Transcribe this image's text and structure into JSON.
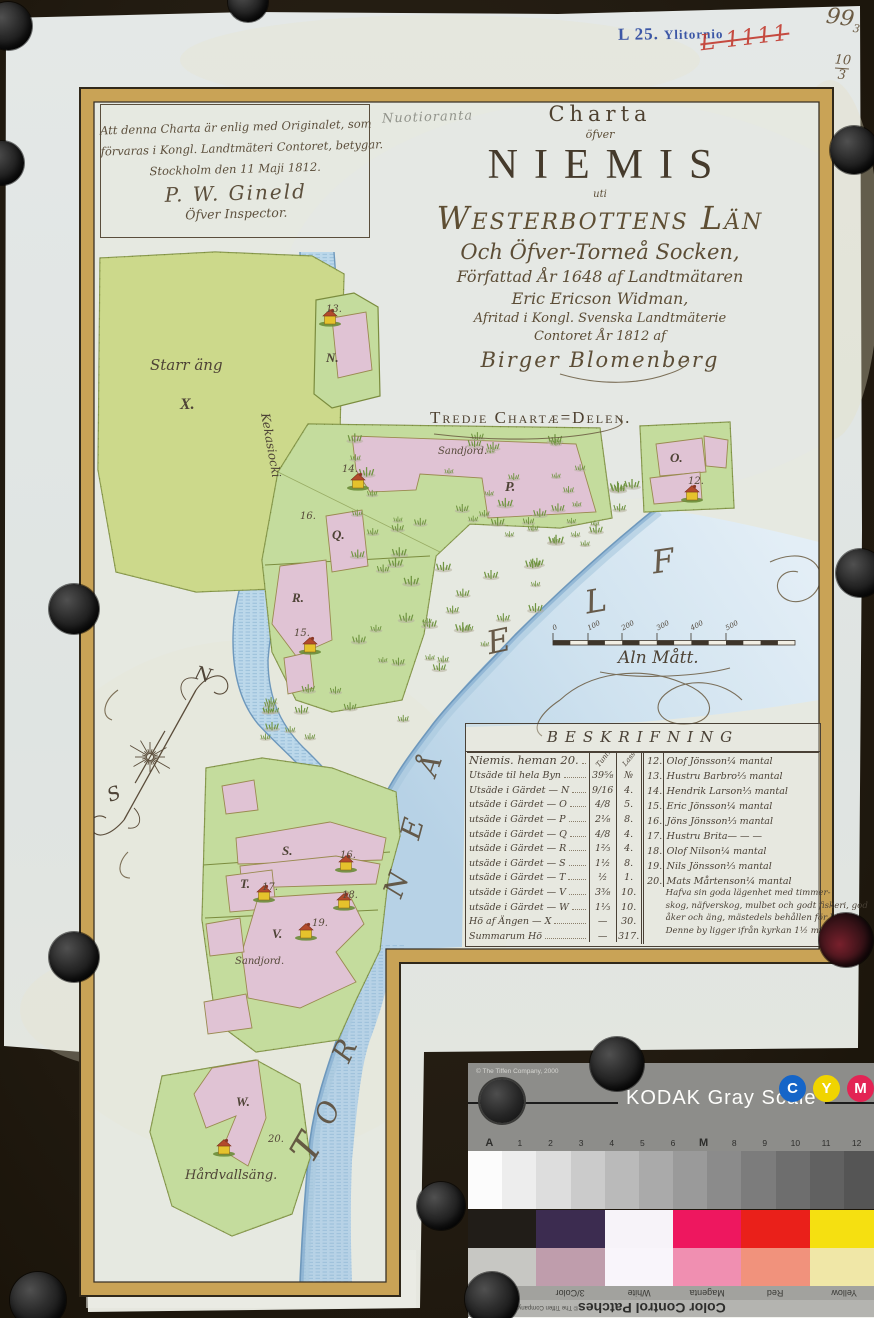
{
  "archive": {
    "stamp_l": "L 25.",
    "stamp_place": "Ylitornio",
    "red_mark": "L 1111",
    "corner_no": "99",
    "corner_no_sub": "3",
    "fraction_top": "10",
    "fraction_bottom": "3",
    "pencil_note": "Nuotioranta"
  },
  "certification": {
    "lines": [
      "Att denna Charta är enlig med Originalet, som",
      "förvaras i Kongl. Landtmäteri Contoret, betygar.",
      "Stockholm den 11 Maji 1812.",
      "P. W. Gineld",
      "Öfver Inspector."
    ]
  },
  "title": {
    "lines": [
      "Charta",
      "öfver",
      "NIEMIS",
      "uti",
      "Westerbottens Län",
      "Och Öfver-Torneå Socken,",
      "Författad År 1648 af Landtmätaren",
      "Eric Ericson Widman,",
      "Afritad i Kongl. Svenska Landtmäterie",
      "Contoret År 1812 af",
      "Birger Blomenberg"
    ],
    "section": "Tredje Chartæ=Delen."
  },
  "map": {
    "labels": [
      {
        "t": "Starr äng",
        "x": 150,
        "y": 356,
        "c": "cursive",
        "s": 15
      },
      {
        "t": "X.",
        "x": 180,
        "y": 396,
        "c": "serif",
        "s": 16
      },
      {
        "t": "Kekasiocki",
        "x": 272,
        "y": 412,
        "c": "cursive",
        "s": 12,
        "r": 80
      },
      {
        "t": "13.",
        "x": 326,
        "y": 304,
        "c": "small"
      },
      {
        "t": "N.",
        "x": 326,
        "y": 350,
        "c": "serif",
        "s": 13
      },
      {
        "t": "Sandjord.",
        "x": 438,
        "y": 446,
        "c": "small"
      },
      {
        "t": "14.",
        "x": 342,
        "y": 464,
        "c": "small"
      },
      {
        "t": "P.",
        "x": 505,
        "y": 480,
        "c": "serif",
        "s": 14
      },
      {
        "t": "16.",
        "x": 300,
        "y": 511,
        "c": "small"
      },
      {
        "t": "Q.",
        "x": 332,
        "y": 527,
        "c": "serif",
        "s": 13
      },
      {
        "t": "R.",
        "x": 292,
        "y": 590,
        "c": "serif",
        "s": 13
      },
      {
        "t": "15.",
        "x": 294,
        "y": 628,
        "c": "small"
      },
      {
        "t": "O.",
        "x": 670,
        "y": 450,
        "c": "serif",
        "s": 13
      },
      {
        "t": "12.",
        "x": 688,
        "y": 476,
        "c": "small"
      },
      {
        "t": "S.",
        "x": 282,
        "y": 843,
        "c": "serif",
        "s": 13
      },
      {
        "t": "16.",
        "x": 340,
        "y": 850,
        "c": "small"
      },
      {
        "t": "T.",
        "x": 240,
        "y": 876,
        "c": "serif",
        "s": 13
      },
      {
        "t": "17.",
        "x": 262,
        "y": 882,
        "c": "small"
      },
      {
        "t": "18.",
        "x": 342,
        "y": 890,
        "c": "small"
      },
      {
        "t": "V.",
        "x": 272,
        "y": 926,
        "c": "serif",
        "s": 13
      },
      {
        "t": "19.",
        "x": 312,
        "y": 918,
        "c": "small"
      },
      {
        "t": "Sandjord.",
        "x": 235,
        "y": 956,
        "c": "small"
      },
      {
        "t": "W.",
        "x": 236,
        "y": 1094,
        "c": "serif",
        "s": 13
      },
      {
        "t": "20.",
        "x": 268,
        "y": 1134,
        "c": "small"
      },
      {
        "t": "Hårdvallsäng.",
        "x": 185,
        "y": 1168,
        "c": "cursive",
        "s": 13
      },
      {
        "t": "N",
        "x": 198,
        "y": 662,
        "c": "cursive",
        "s": 19,
        "r": 15
      },
      {
        "t": "S",
        "x": 104,
        "y": 786,
        "c": "cursive",
        "s": 19,
        "r": -20
      }
    ],
    "river_letters": [
      {
        "ch": "E",
        "x": 487,
        "y": 622,
        "r": -12,
        "s": 32
      },
      {
        "ch": "L",
        "x": 585,
        "y": 582,
        "r": -10,
        "s": 32
      },
      {
        "ch": "F",
        "x": 652,
        "y": 542,
        "r": -8,
        "s": 32
      },
      {
        "ch": "Å",
        "x": 420,
        "y": 748,
        "r": -70,
        "s": 28
      },
      {
        "ch": "E",
        "x": 402,
        "y": 812,
        "r": -75,
        "s": 28
      },
      {
        "ch": "N",
        "x": 384,
        "y": 868,
        "r": -70,
        "s": 28
      },
      {
        "ch": "R",
        "x": 334,
        "y": 1034,
        "r": -65,
        "s": 28
      },
      {
        "ch": "O",
        "x": 316,
        "y": 1096,
        "r": -70,
        "s": 28
      },
      {
        "ch": "T",
        "x": 294,
        "y": 1126,
        "r": -60,
        "s": 38
      }
    ],
    "scale": {
      "ticks": [
        "0",
        "100",
        "200",
        "300",
        "400",
        "500"
      ],
      "caption": "Aln Mått."
    }
  },
  "table": {
    "header": "BESKRIFNING",
    "col_heads": [
      "Tunl.",
      "Lass"
    ],
    "no_head": "№",
    "left_rows": [
      {
        "n": "Niemis. heman 20.",
        "v1": "",
        "v2": ""
      },
      {
        "n": "Utsäde til hela Byn",
        "v1": "39⅝",
        "v2": "№"
      },
      {
        "n": "Utsäde i Gärdet — N",
        "v1": "9/16",
        "v2": "4."
      },
      {
        "n": "utsäde i Gärdet — O",
        "v1": "4/8",
        "v2": "5."
      },
      {
        "n": "utsäde i Gärdet — P",
        "v1": "2⅛",
        "v2": "8."
      },
      {
        "n": "utsäde i Gärdet — Q",
        "v1": "4/8",
        "v2": "4."
      },
      {
        "n": "utsäde i Gärdet — R",
        "v1": "1⅔",
        "v2": "4."
      },
      {
        "n": "utsäde i Gärdet — S",
        "v1": "1½",
        "v2": "8."
      },
      {
        "n": "utsäde i Gärdet — T",
        "v1": "½",
        "v2": "1."
      },
      {
        "n": "utsäde i Gärdet — V",
        "v1": "3⅜",
        "v2": "10."
      },
      {
        "n": "utsäde i Gärdet — W",
        "v1": "1⅓",
        "v2": "10."
      },
      {
        "n": "Hö af Ängen — X",
        "v1": "—",
        "v2": "30."
      },
      {
        "n": "Summarum Hö",
        "v1": "—",
        "v2": "317."
      }
    ],
    "right_rows": [
      {
        "no": "12.",
        "name": "Olof Jönsson",
        "share": "¼ mantal"
      },
      {
        "no": "13.",
        "name": "Hustru Barbro",
        "share": "⅓ mantal"
      },
      {
        "no": "14.",
        "name": "Hendrik Larson",
        "share": "⅓ mantal"
      },
      {
        "no": "15.",
        "name": "Eric Jönsson",
        "share": "¼ mantal"
      },
      {
        "no": "16.",
        "name": "Jöns Jönsson",
        "share": "⅓ mantal"
      },
      {
        "no": "17.",
        "name": "Hustru Brita",
        "share": "— — —"
      },
      {
        "no": "18.",
        "name": "Olof Nilson",
        "share": "¼ mantal"
      },
      {
        "no": "19.",
        "name": "Nils Jönsson",
        "share": "⅓ mantal"
      },
      {
        "no": "20.",
        "name": "Mats Mårtenson",
        "share": "¼ mantal"
      }
    ],
    "note_lines": [
      "Hafva sin goda lägenhet med timmer-",
      "skog, näfverskog, mulbet och godt fiskeri, god",
      "åker och äng, mästedels behållen för kält —",
      "Denne by ligger ifrån kyrkan 1½ mil."
    ]
  },
  "kodak_gray": {
    "copyright": "© The Tiffen Company, 2000",
    "title": "KODAK Gray Scale",
    "dots": [
      {
        "l": "C",
        "bg": "#1565c8"
      },
      {
        "l": "Y",
        "bg": "#f0d400"
      },
      {
        "l": "M",
        "bg": "#e32454"
      }
    ],
    "index": [
      "A",
      "1",
      "2",
      "3",
      "4",
      "5",
      "6",
      "M",
      "8",
      "9",
      "10",
      "11",
      "12"
    ],
    "patches": [
      "#fcfcfc",
      "#ededed",
      "#dddddd",
      "#cbcbcb",
      "#bababa",
      "#aaaaaa",
      "#9a9a9a",
      "#8b8b8b",
      "#7c7c7c",
      "#6e6e6e",
      "#616161",
      "#555555"
    ]
  },
  "kodak_color": {
    "top": [
      "#211d18",
      "#3c2c50",
      "#f7f3f9",
      "#ee175f",
      "#ea201a",
      "#f5e011"
    ],
    "bottom": [
      "#c7c7c3",
      "#bf9dac",
      "#f9f5fb",
      "#f08fb1",
      "#f1927c",
      "#f0e7a7"
    ],
    "labels": [
      "B",
      "3/Color",
      "White",
      "Magenta",
      "Red",
      "Yellow"
    ],
    "strip_title": "Color Control Patches",
    "copyright": "© The Tiffen Company, 2000",
    "logo": "KO",
    "license": "LICENSED"
  }
}
